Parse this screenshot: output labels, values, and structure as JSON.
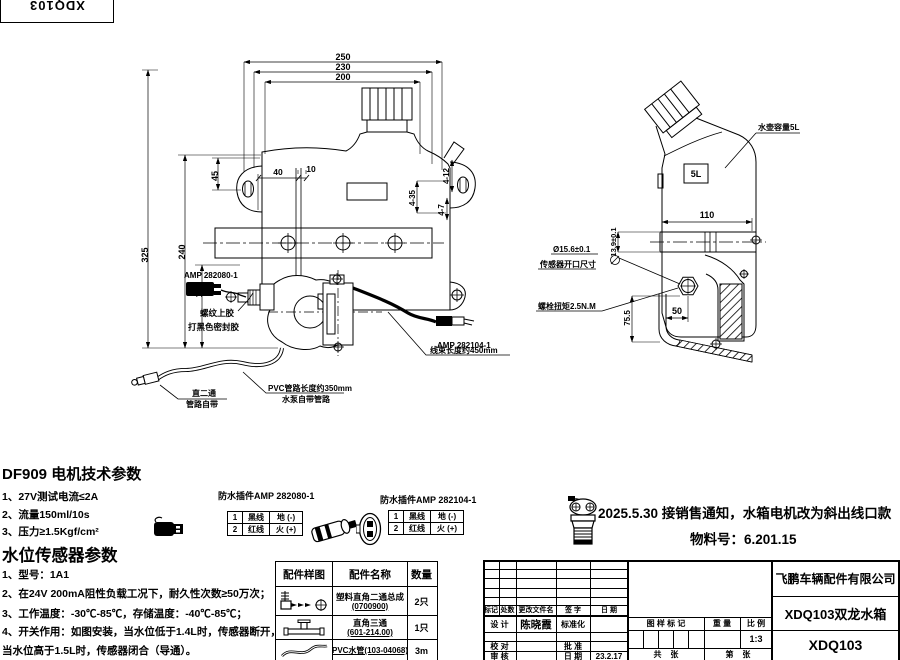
{
  "top_code": "XDQ103",
  "front_view": {
    "dim_250": "250",
    "dim_230": "230",
    "dim_200": "200",
    "dim_40": "40",
    "dim_10": "10",
    "dim_325": "325",
    "dim_240": "240",
    "dim_133": "133",
    "dim_45": "45",
    "dim_4_35": "4-35",
    "dim_4_12": "4-12",
    "dim_4_7": "4-7",
    "label_amp_motor": "AMP 282080-1",
    "label_thread_glue": "螺纹上胶",
    "label_black_sealant": "打黑色密封胶",
    "label_amp_sensor": "AMP 282104-1",
    "label_harness_length": "线束长度约450mm",
    "label_pvc_length": "PVC管路长度约350mm",
    "label_pump_tube": "水泵自带管路",
    "label_straight_fitting": "直二通",
    "label_tube_included": "管路自带"
  },
  "side_view": {
    "label_capacity": "水壶容量5L",
    "label_volume": "5L",
    "dim_110": "110",
    "dim_depth": "13.9±0.1",
    "dim_opening": "Ø15.6±0.1",
    "label_sensor_opening": "传感器开口尺寸",
    "label_bolt_torque": "螺栓扭矩2.5N.M",
    "dim_75_5": "75.5",
    "dim_50": "50"
  },
  "motor_specs": {
    "title": "DF909 电机技术参数",
    "items": [
      "1、27V测试电流≤2A",
      "2、流量150ml/10s",
      "3、压力≥1.5Kgf/cm²"
    ]
  },
  "sensor_specs": {
    "title": "水位传感器参数",
    "items": [
      "1、型号：1A1",
      "2、在24V 200mA阻性负载工况下，耐久性次数≥50万次；",
      "3、工作温度：-30℃-85℃，存储温度：-40℃-85℃；",
      "4、开关作用：如图安装，当水位低于1.4L时，传感器断开，",
      "当水位高于1.5L时，传感器闭合（导通）。"
    ]
  },
  "connectors": [
    {
      "title": "防水插件AMP 282080-1",
      "rows": [
        [
          "1",
          "黑线",
          "地 (-)"
        ],
        [
          "2",
          "红线",
          "火 (+)"
        ]
      ]
    },
    {
      "title": "防水插件AMP 282104-1",
      "rows": [
        [
          "1",
          "黑线",
          "地 (-)"
        ],
        [
          "2",
          "红线",
          "火 (+)"
        ]
      ]
    }
  ],
  "notice": {
    "line1": "2025.5.30   接销售通知，水箱电机改为斜出线口款",
    "line2": "物料号：6.201.15"
  },
  "parts_table": {
    "headers": [
      "配件样图",
      "配件名称",
      "数量"
    ],
    "rows": [
      {
        "name": "塑料直角二通总成",
        "code": "(0700900)",
        "qty": "2只"
      },
      {
        "name": "直角三通",
        "code": "(601-214.00)",
        "qty": "1只"
      },
      {
        "name": "PVC水管(103-04068)",
        "code": "",
        "qty": "3m"
      }
    ]
  },
  "title_block": {
    "company": "飞鹏车辆配件有限公司",
    "drawing_name": "XDQ103双龙水箱",
    "drawing_no": "XDQ103",
    "rev_cols": [
      "标记",
      "处数",
      "更改文件名",
      "签 字",
      "日 期"
    ],
    "design_label": "设 计",
    "designer": "陈晓霞",
    "standard_label": "标准化",
    "check_label": "校 对",
    "approve_label": "批 准",
    "audit_label": "审 核",
    "date_label": "日 期",
    "date_value": "23.2.17",
    "stamp_label": "图 样 标 记",
    "weight_label": "重 量",
    "scale_label": "比 例",
    "scale_value": "1:3",
    "sheet_left": "共    张",
    "sheet_right": "第    张"
  }
}
